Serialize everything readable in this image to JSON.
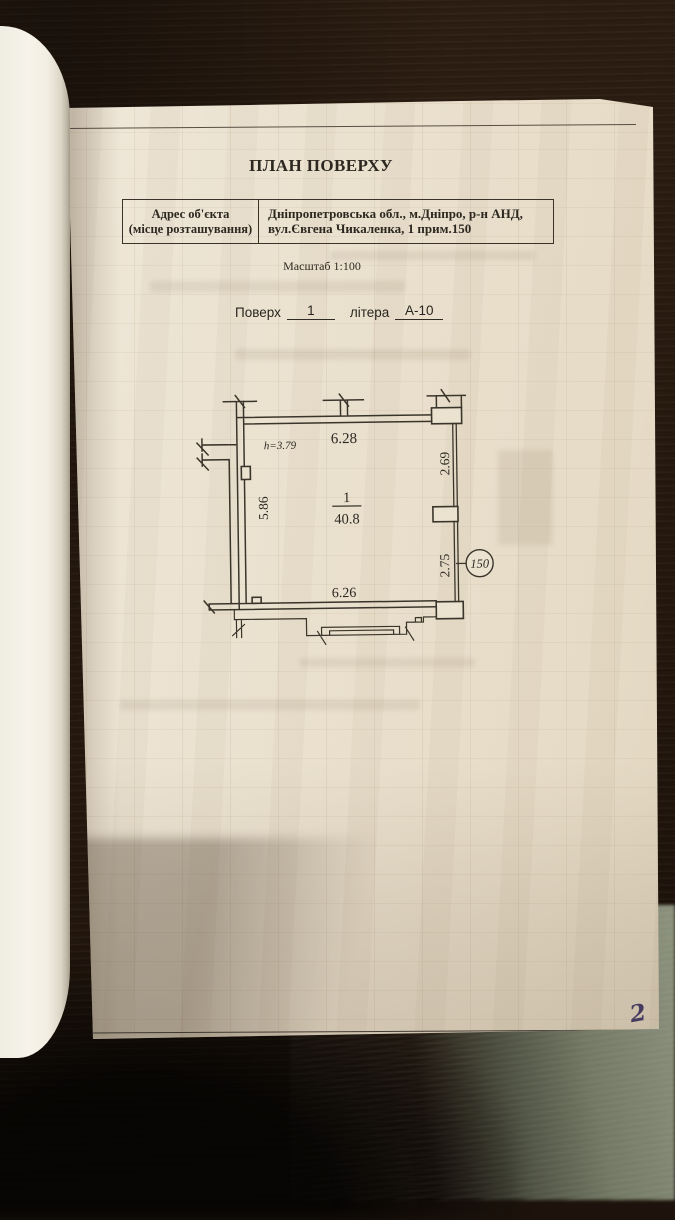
{
  "page": {
    "title": "ПЛАН ПОВЕРХУ",
    "address_table": {
      "label_line1": "Адрес об'єкта",
      "label_line2": "(місце розташування)",
      "value_line1": "Дніпропетровська обл., м.Дніпро, р-н АНД,",
      "value_line2": "вул.Євгена Чикаленка, 1 прим.150"
    },
    "scale_label": "Масштаб 1:100",
    "floor_row": {
      "floor_label": "Поверх",
      "floor_value": "1",
      "letter_label": "літера",
      "letter_value": "А-10"
    },
    "page_number": "2"
  },
  "plan": {
    "room_number": "1",
    "room_area": "40.8",
    "ceiling_height": "h=3.79",
    "dim_top": "6.28",
    "dim_right_upper": "2.69",
    "dim_left": "5.86",
    "dim_right_lower": "2.75",
    "dim_bottom": "6.26",
    "apartment_number": "150"
  },
  "colors": {
    "paper": "#e9dfcc",
    "ink": "#2c2822",
    "plan_line": "#3a352b",
    "wood_dark": "#22160d",
    "wood_light": "#8e9680",
    "handwriting_ink": "#453b60"
  }
}
